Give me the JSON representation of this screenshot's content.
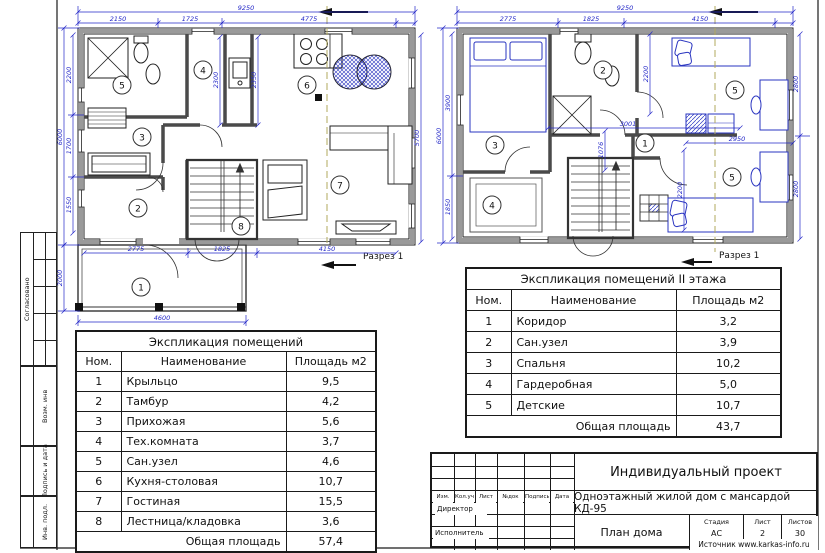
{
  "margin": {
    "fields": [
      "Согласовано",
      "Возм. инв",
      "Подпись и дата",
      "Инв. подл."
    ]
  },
  "plan1": {
    "section": "Разрез 1",
    "rooms": [
      "1",
      "2",
      "3",
      "4",
      "5",
      "6",
      "7",
      "8"
    ],
    "dims": {
      "ow": "9250",
      "t": [
        "2150",
        "1725",
        "4775"
      ],
      "oh": "6000",
      "l": [
        "2200",
        "1700",
        "1550"
      ],
      "porch_h": "2000",
      "porch_w": "4600",
      "b": [
        "2775",
        "1825",
        "4150"
      ],
      "r": "5700",
      "i": [
        "2300",
        "2350"
      ]
    }
  },
  "plan2": {
    "section": "Разрез 1",
    "rooms": [
      "1",
      "2",
      "3",
      "4",
      "5",
      "5"
    ],
    "dims": {
      "ow": "9250",
      "t": [
        "2775",
        "1825",
        "4150"
      ],
      "oh": "6000",
      "l": [
        "3900",
        "1850"
      ],
      "r": [
        "2800",
        "2800"
      ],
      "i": [
        "3001",
        "1076",
        "2950",
        "2200",
        "2200"
      ]
    }
  },
  "table1": {
    "title": "Экспликация помещений",
    "headers": [
      "Ном.",
      "Наименование",
      "Площадь м2"
    ],
    "rows": [
      [
        "1",
        "Крыльцо",
        "9,5"
      ],
      [
        "2",
        "Тамбур",
        "4,2"
      ],
      [
        "3",
        "Прихожая",
        "5,6"
      ],
      [
        "4",
        "Тех.комната",
        "3,7"
      ],
      [
        "5",
        "Сан.узел",
        "4,6"
      ],
      [
        "6",
        "Кухня-столовая",
        "10,7"
      ],
      [
        "7",
        "Гостиная",
        "15,5"
      ],
      [
        "8",
        "Лестница/кладовка",
        "3,6"
      ]
    ],
    "total_label": "Общая площадь",
    "total": "57,4"
  },
  "table2": {
    "title": "Экспликация помещений II этажа",
    "headers": [
      "Ном.",
      "Наименование",
      "Площадь м2"
    ],
    "rows": [
      [
        "1",
        "Коридор",
        "3,2"
      ],
      [
        "2",
        "Сан.узел",
        "3,9"
      ],
      [
        "3",
        "Спальня",
        "10,2"
      ],
      [
        "4",
        "Гардеробная",
        "5,0"
      ],
      [
        "5",
        "Детские",
        "10,7"
      ]
    ],
    "total_label": "Общая площадь",
    "total": "43,7"
  },
  "titleblock": {
    "cols": [
      "Изм.",
      "Кол.уч",
      "Лист",
      "№док",
      "Подпись",
      "Дата"
    ],
    "director": "Директор",
    "executor": "Исполнитель",
    "project": "Индивидуальный проект",
    "object": "Одноэтажный жилой дом с мансардой КД-95",
    "stage_label": "Стадия",
    "sheet_label": "Лист",
    "sheets_label": "Листов",
    "stage": "АС",
    "sheet": "2",
    "sheets": "30",
    "drawing": "План дома",
    "source": "Источник www.karkas-info.ru"
  }
}
